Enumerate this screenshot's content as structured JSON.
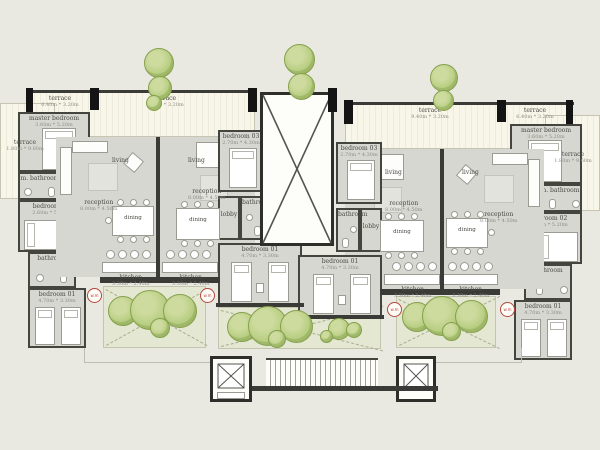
{
  "colors": {
    "background": "#e9e9e1",
    "floor": "#d7d7d2",
    "terrace": "#f8f5e9",
    "courtyard": "#e4e7d1",
    "wall": "#3a3a36",
    "tree": "#b6cd7f",
    "badge": "#b5473c"
  },
  "rooms": {
    "terrace": {
      "label": "terrace",
      "dims": "6.40m * 3.20m"
    },
    "terrace_wide": {
      "label": "terrace",
      "dims": "9.40m * 3.20m"
    },
    "side_terrace": {
      "label": "terrace",
      "dims": "1.80m * 9.60m"
    },
    "master_bedroom": {
      "label": "master bedroom",
      "dims": "3.60m * 5.20m"
    },
    "m_bathroom": {
      "label": "m. bathroom",
      "dims": "1.70m * 2.60m"
    },
    "bedroom_01": {
      "label": "bedroom 01",
      "dims": "4.70m * 3.30m"
    },
    "bedroom_02": {
      "label": "bedroom 02",
      "dims": "2.60m * 5.20m"
    },
    "bedroom_03": {
      "label": "bedroom 03",
      "dims": "2.70m * 4.30m"
    },
    "bathroom": {
      "label": "bathroom",
      "dims": "1.70m * 2.40m"
    },
    "lobby": {
      "label": "lobby",
      "dims": "2.00m * 3.20m"
    },
    "living": {
      "label": "living"
    },
    "reception": {
      "label": "reception",
      "dims": "8.00m * 4.50m"
    },
    "dining": {
      "label": "dining"
    },
    "kitchen": {
      "label": "kitchen",
      "dims": "3.30m * 2.40m"
    }
  },
  "badge": {
    "label": "w.m"
  }
}
